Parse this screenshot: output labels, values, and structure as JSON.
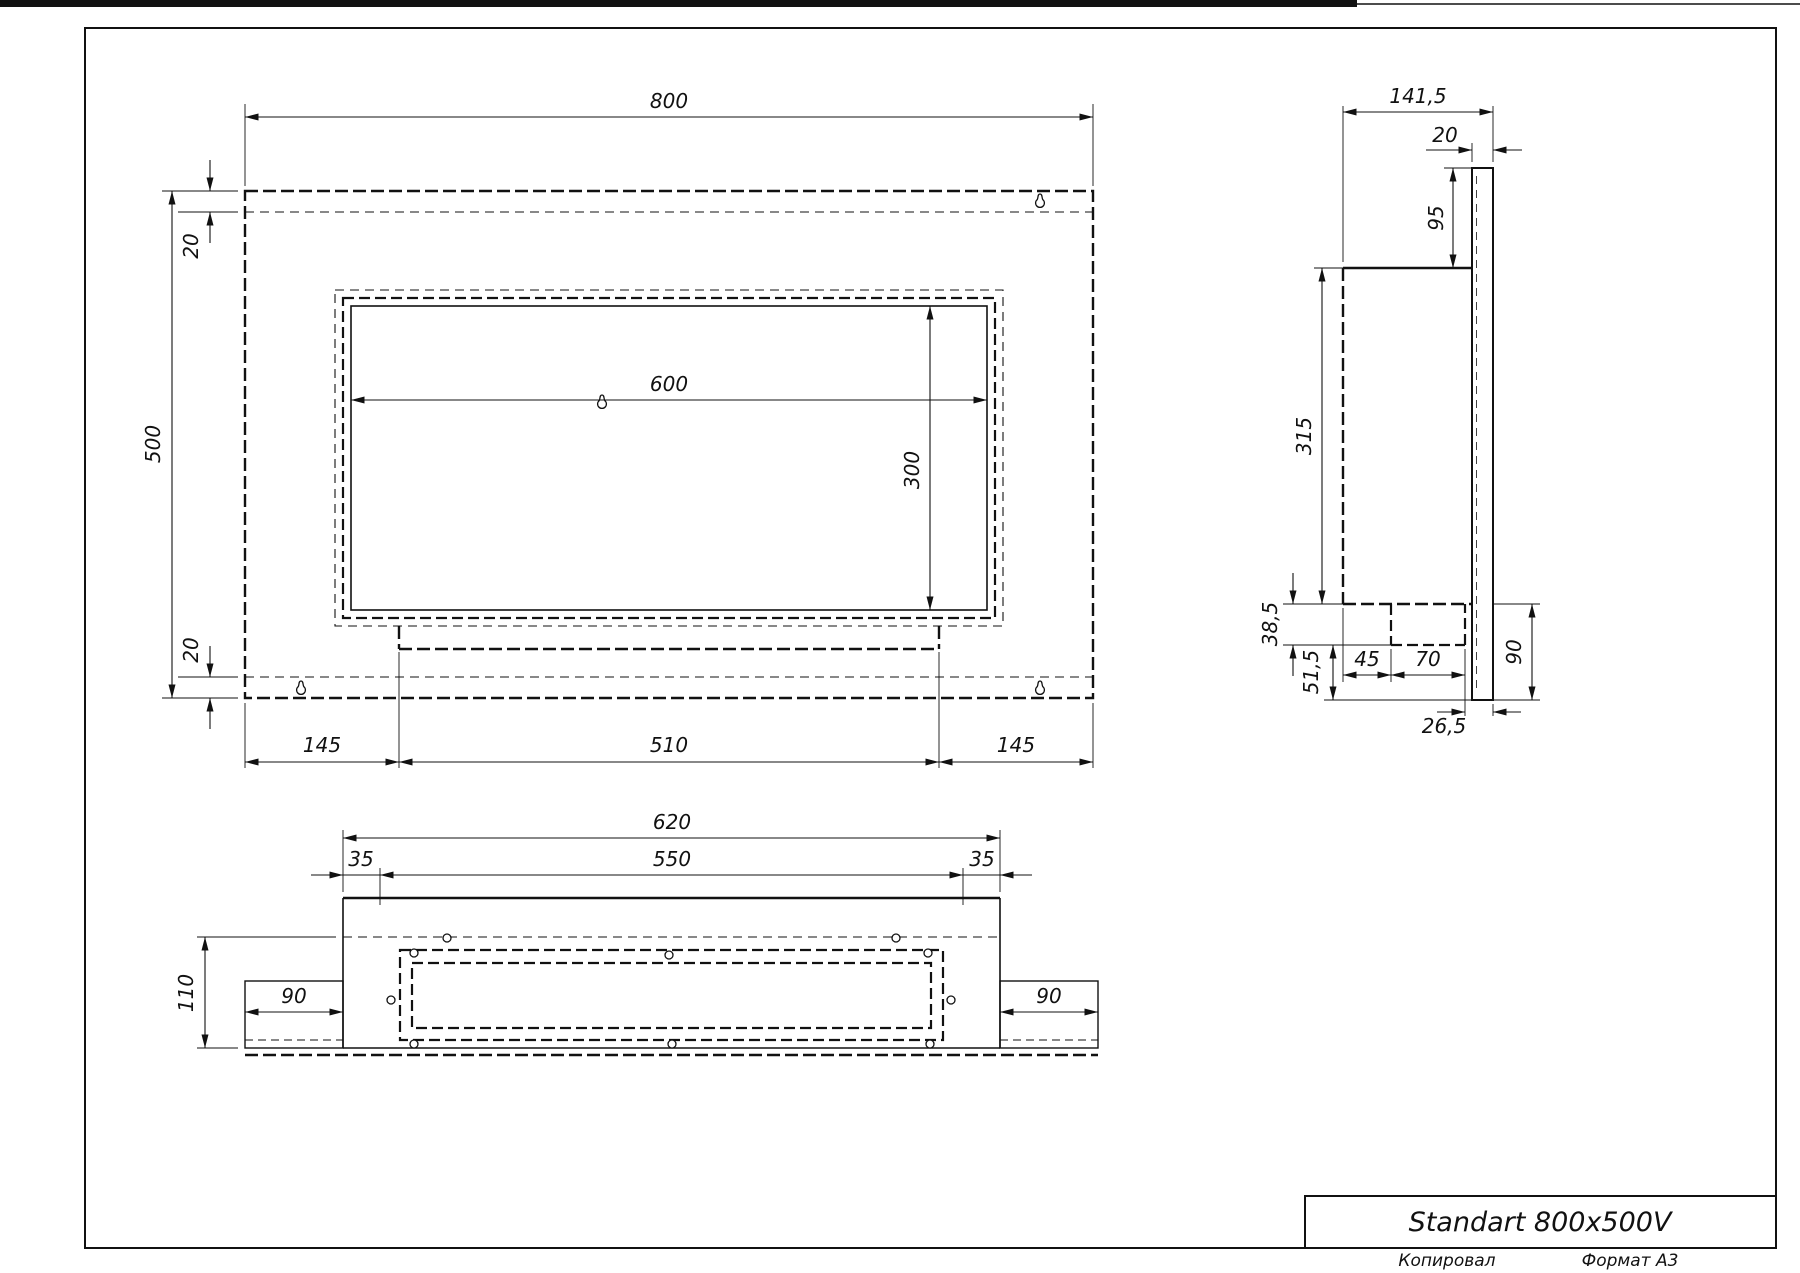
{
  "title_block": {
    "title": "Standart 800x500V"
  },
  "footer": {
    "copied": "Копировал",
    "format": "Формат А3"
  },
  "front_view": {
    "width": "800",
    "height": "500",
    "margin_top": "20",
    "margin_bottom": "20",
    "opening_width": "600",
    "opening_height": "300",
    "left_offset": "145",
    "tray_width": "510",
    "right_offset": "145"
  },
  "side_view": {
    "depth": "141,5",
    "plate_thickness": "20",
    "top_offset": "95",
    "body_height": "315",
    "burner_depth": "38,5",
    "bottom_offset": "51,5",
    "burner_front_offset": "45",
    "burner_width": "70",
    "plate_bottom": "90",
    "back_gap": "26,5"
  },
  "bottom_view": {
    "outer_width": "620",
    "inner_width": "550",
    "margin_left": "35",
    "margin_right": "35",
    "depth": "110",
    "flange_left": "90",
    "flange_right": "90"
  }
}
